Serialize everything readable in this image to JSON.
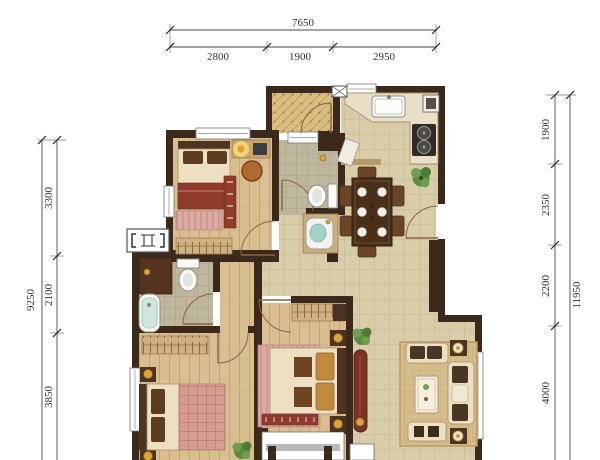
{
  "page": {
    "type": "apartment-floor-plan",
    "background": "#ffffff"
  },
  "palette": {
    "paper": "#ffffff",
    "wall": "#3b2a1c",
    "wall_light": "#b39a6f",
    "door": "#8a6442",
    "wood_floor": "#d9be92",
    "tile_floor": "#d9cda9",
    "bath_floor": "#bfb69e",
    "balcony_floor": "#dabd85",
    "furniture_cream": "#ecdfc2",
    "dark_wood": "#4e3320",
    "accent_maroon": "#8e3b2c",
    "rug_pink": "#dcaaa2",
    "gold": "#d9a43c",
    "plant_green": "#5d8a42",
    "water_teal": "#9fd2c8",
    "dim_text": "#333333"
  },
  "dimensions": {
    "top": {
      "total": "7650",
      "segments": [
        "2800",
        "1900",
        "2950"
      ]
    },
    "left": {
      "total": "9250",
      "segments": [
        "3300",
        "2100",
        "3850"
      ]
    },
    "right": {
      "total": "11950",
      "segments": [
        "1900",
        "2350",
        "2200",
        "4000"
      ]
    }
  },
  "icons": {
    "door-swing-icon": "quarter-arc",
    "plant-icon": "leaf-cluster",
    "ac-unit-icon": "bracket-box",
    "flue-icon": "x-box",
    "stove-icon": "two-burners",
    "toilet-icon": "tank-and-bowl",
    "bathtub-icon": "rounded-tub",
    "sink-icon": "basin",
    "lamp-icon": "glow-circle"
  }
}
